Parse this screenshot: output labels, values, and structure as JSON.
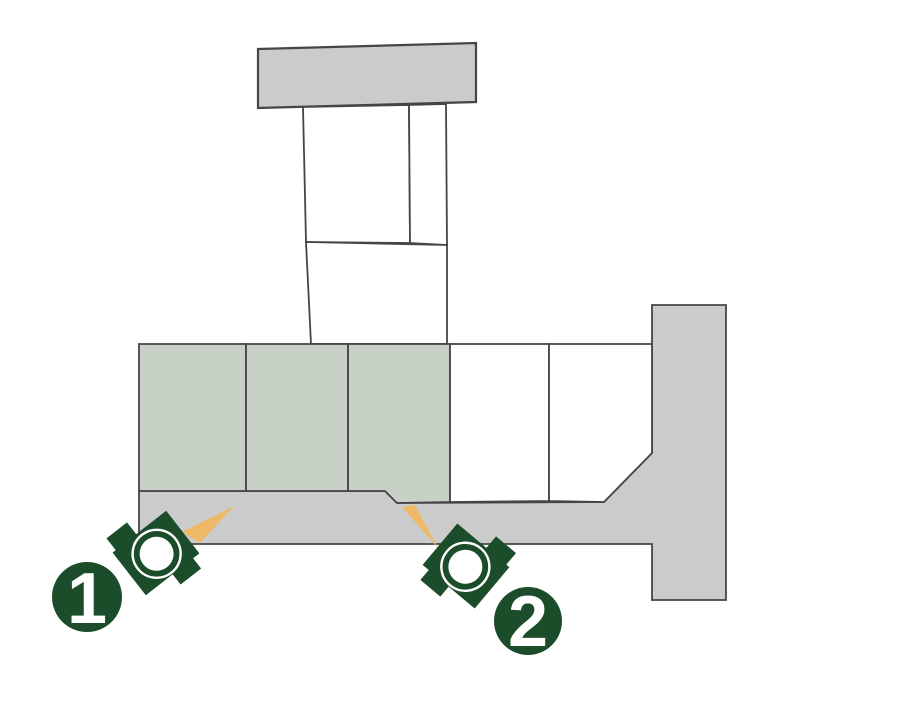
{
  "colors": {
    "background": "#ffffff",
    "road": "#cbcbcb",
    "lot_highlight": "#c7d1c6",
    "lot_plain": "#ffffff",
    "outline": "#454545",
    "marker": "#1b4d2a",
    "wedge": "#edb968",
    "lens": "#ffffff"
  },
  "markers": [
    {
      "number": "1"
    },
    {
      "number": "2"
    }
  ]
}
